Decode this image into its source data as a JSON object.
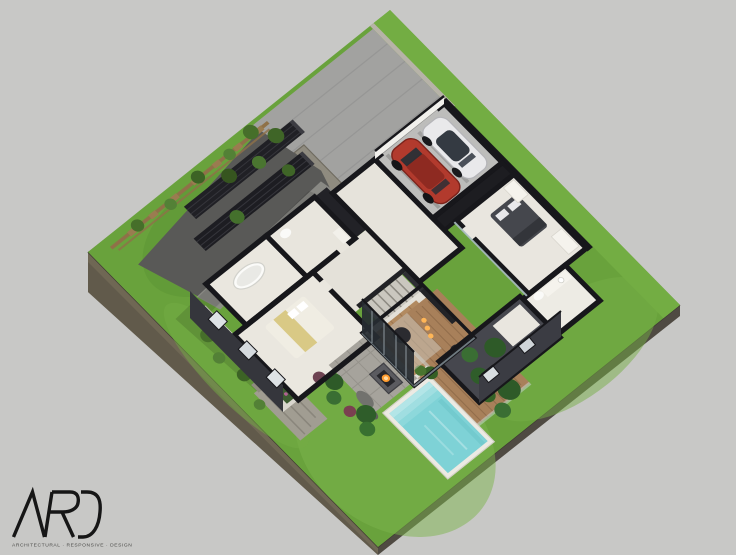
{
  "canvas": {
    "width": 736,
    "height": 555,
    "background": "#c8c8c6"
  },
  "logo": {
    "name": "ARD",
    "tagline": "ARCHITECTURAL · RESPONSIVE · DESIGN"
  },
  "palette": {
    "background": "#c8c8c6",
    "grass": "#69a23c",
    "grass-light": "#7cb44c",
    "concrete": "#a2a2a0",
    "gravel": "#595957",
    "wall": "#17171b",
    "floor": "#e9e6df",
    "wood-deck": "#a8805a",
    "wood-floor": "#b28a60",
    "pool-water": "#7ed2d6",
    "pool-deck": "#eceae3",
    "soil": "#6f6754",
    "soil-dark": "#4f4a42",
    "car-red": "#b23a2d",
    "car-white": "#e9e9eb",
    "fence-wood": "#8f7148",
    "foliage": "#2e5a28",
    "flame": "#ff9b2e",
    "patio": "#a6a39c",
    "trellis": "#202025",
    "logo-ink": "#161616"
  },
  "scene": {
    "type": "isometric-exterior-cutaway-render",
    "objects": [
      "lawn",
      "driveway",
      "stone-curb",
      "timber-fence",
      "trellis-green-wall",
      "gravel-path",
      "garage",
      "white-car",
      "red-car",
      "stair-core",
      "master-bedroom",
      "master-bed",
      "wardrobes",
      "ensuite-bathroom",
      "hallway",
      "bathroom-tub",
      "vanity",
      "second-bedroom",
      "balcony-planters",
      "living-pavilion",
      "pendant-lights",
      "outdoor-stairs",
      "paver-patio",
      "fire-pit",
      "wood-deck",
      "outdoor-dining-set",
      "swimming-pool",
      "pool-steps",
      "garden-shrubs",
      "rocks",
      "garden-wing"
    ]
  }
}
